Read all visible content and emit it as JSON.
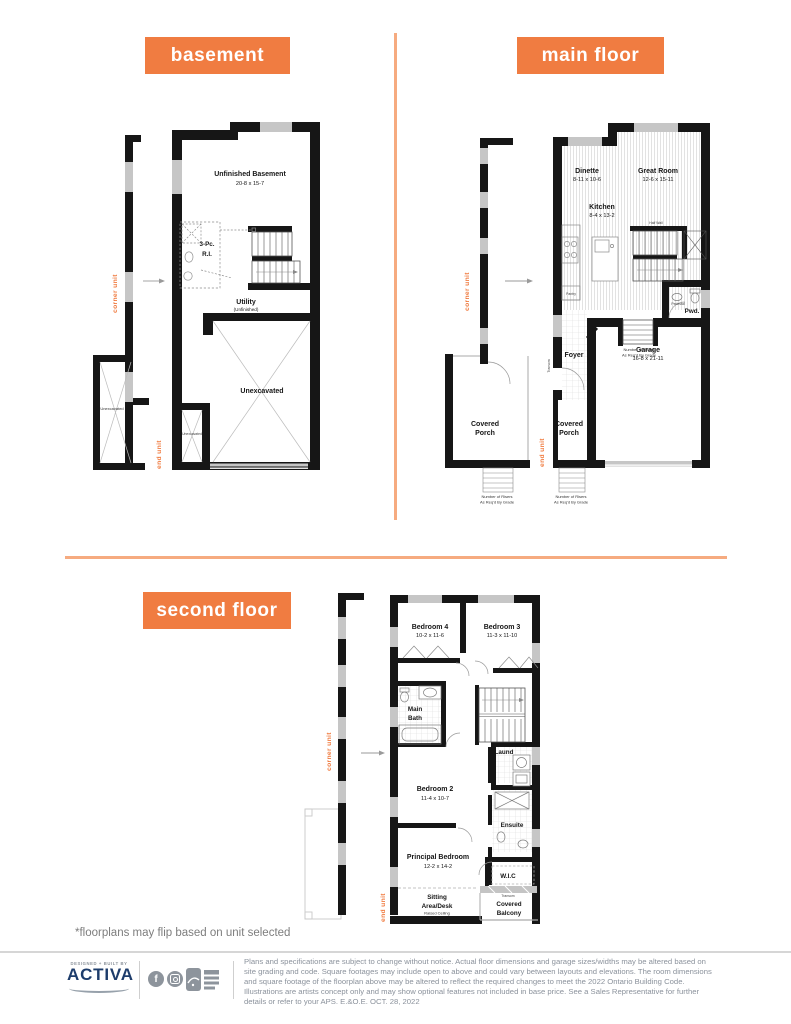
{
  "colors": {
    "accent": "#f07c41",
    "divider": "#f6ab80",
    "brand_blue": "#1d3c6b"
  },
  "basement": {
    "title": "basement",
    "corner_unit": "corner unit",
    "end_unit": "end unit",
    "unfinished": {
      "name": "Unfinished Basement",
      "dims": "20-8 x 15-7"
    },
    "rough_in": {
      "line1": "3-Pc.",
      "line2": "R.I."
    },
    "utility": {
      "name": "Utility",
      "sub": "(Unfinished)"
    },
    "unexcavated_main": "Unexcavated",
    "unexcavated_left": "Unexcavated",
    "unexcavated_mid": "Unexcavated"
  },
  "main_floor": {
    "title": "main floor",
    "corner_unit": "corner unit",
    "end_unit": "end unit",
    "dinette": {
      "name": "Dinette",
      "dims": "8-11 x 10-6"
    },
    "great_room": {
      "name": "Great Room",
      "dims": "12-6 x 15-11"
    },
    "kitchen": {
      "name": "Kitchen",
      "dims": "8-4 x 13-2"
    },
    "pwd": "Pwd.",
    "pedestal": "Pedestal",
    "pantry": "Pantry",
    "half_wall": "Half Wall",
    "transom": "Transom",
    "foyer": "Foyer",
    "garage": {
      "name": "Garage",
      "dims": "16-8 x 21-11"
    },
    "porch_left": {
      "line1": "Covered",
      "line2": "Porch"
    },
    "porch_right": {
      "line1": "Covered",
      "line2": "Porch"
    },
    "risers": {
      "line1": "Number of Risers",
      "line2": "As Req'd By Grade"
    }
  },
  "second_floor": {
    "title": "second floor",
    "corner_unit": "corner unit",
    "end_unit": "end unit",
    "bedroom4": {
      "name": "Bedroom 4",
      "dims": "10-2 x 11-6"
    },
    "bedroom3": {
      "name": "Bedroom 3",
      "dims": "11-3 x 11-10"
    },
    "main_bath": {
      "line1": "Main",
      "line2": "Bath"
    },
    "laundry": "Laund",
    "bedroom2": {
      "name": "Bedroom 2",
      "dims": "11-4 x 10-7"
    },
    "ensuite": "Ensuite",
    "principal": {
      "name": "Principal Bedroom",
      "dims": "12-2 x 14-2"
    },
    "wic": "W.I.C",
    "sitting": {
      "line1": "Sitting",
      "line2": "Area/Desk",
      "line3": "Raised Ceiling"
    },
    "balcony": {
      "line1": "Covered",
      "line2": "Balcony"
    },
    "transom": "Transom"
  },
  "footnote": "*floorplans may flip based on unit selected",
  "footer": {
    "tagline": "DESIGNED + BUILT BY",
    "brand": "ACTIVA",
    "facebook_glyph": "f",
    "disclaimer": "Plans and specifications are subject to change without notice. Actual floor dimensions and garage sizes/widths may be altered based on site grading and code. Square footages may include open to above and could vary between layouts and elevations. The room dimensions and square footage of the floorplan above may be altered to reflect the required changes to meet the 2022 Ontario Building Code. Illustrations are artists concept only and may show optional features not included in base price. See a Sales Representative for further details or refer to your APS. E.&O.E. OCT. 28, 2022"
  }
}
